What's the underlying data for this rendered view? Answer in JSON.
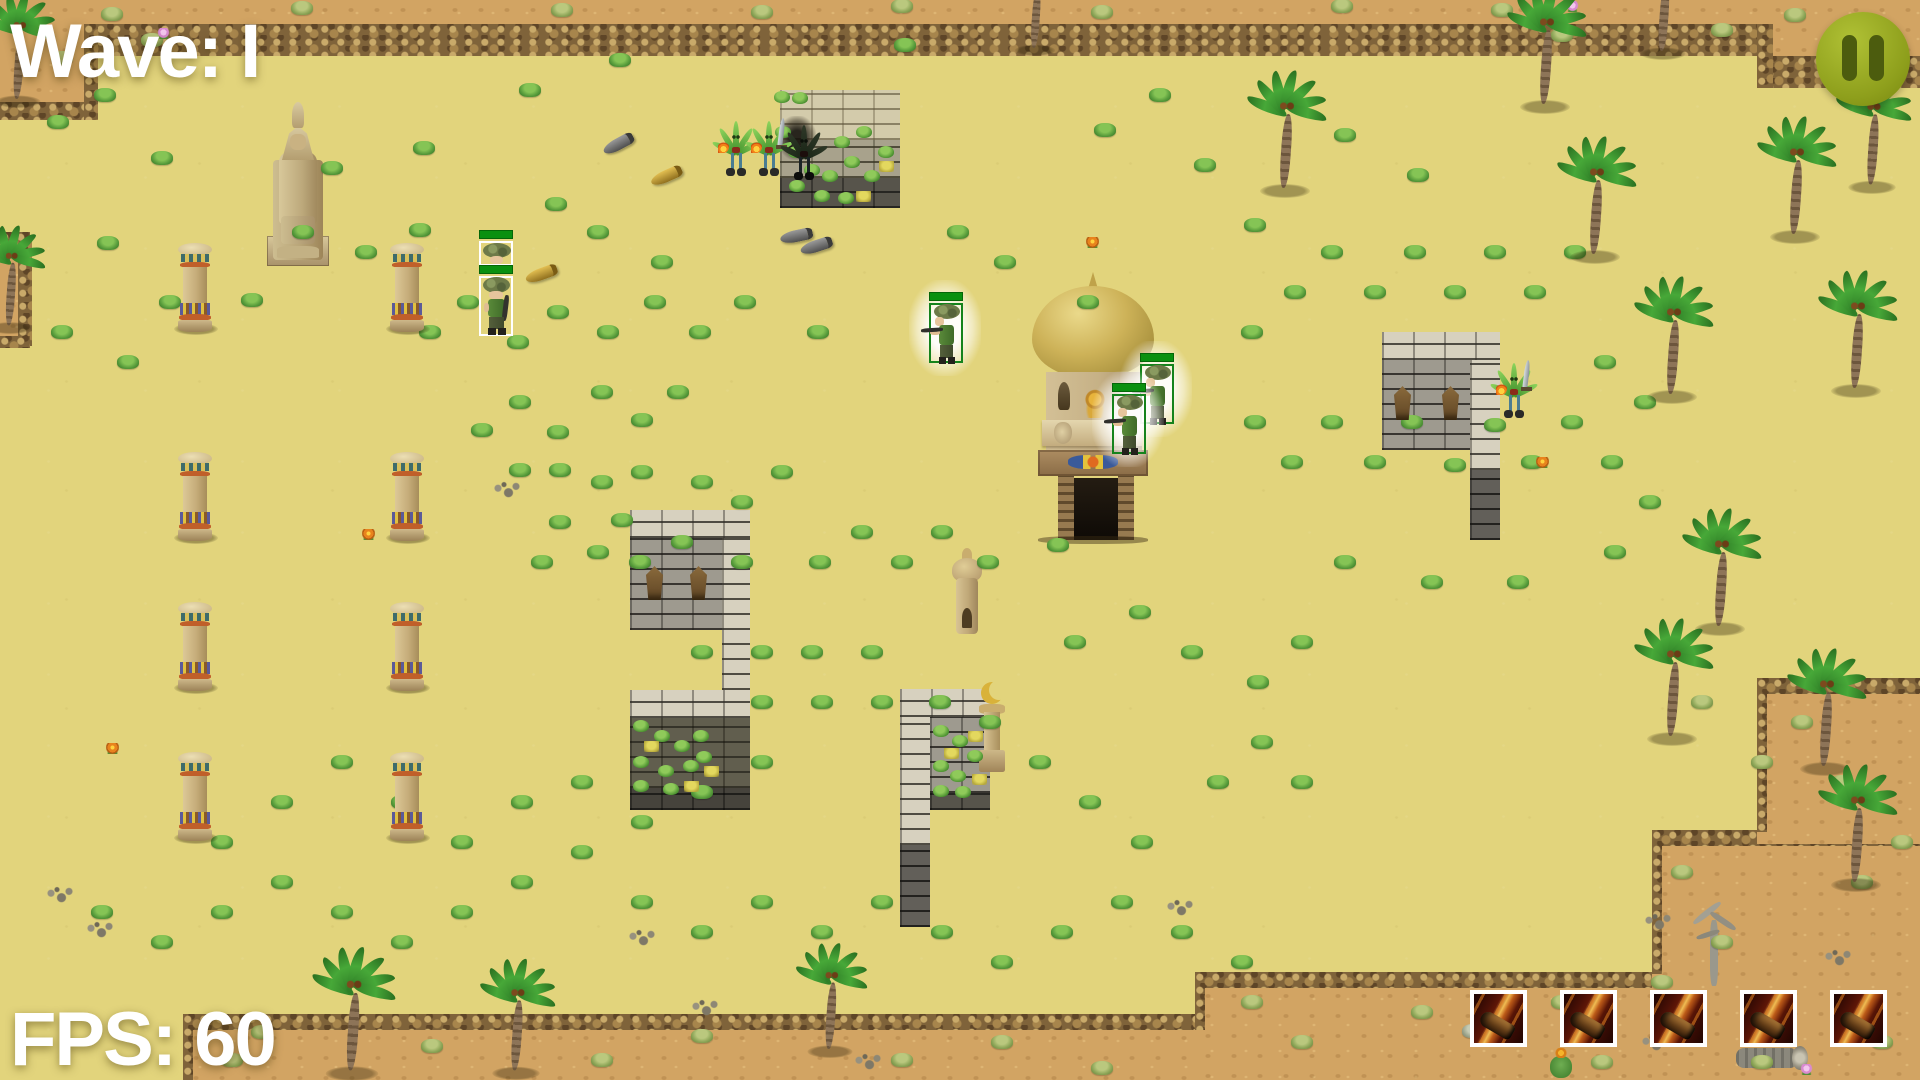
{
  "hud": {
    "wave_label": "Wave: I",
    "fps_label": "FPS: 60",
    "text_color": "#ffffff"
  },
  "pause_button": {
    "icon": "pause-icon",
    "bg_color": "#8e9f1c",
    "bar_color": "#4c5c0e"
  },
  "ability_bar": {
    "slot_count": 5,
    "icon": "fire-shot-icon",
    "border_color": "#ffffff"
  },
  "units": {
    "hp_color": "#0a9010",
    "soldiers": [
      {
        "x": 479,
        "y": 230,
        "style": "white",
        "variant": "hat",
        "glow": false,
        "hp": 1.0
      },
      {
        "x": 479,
        "y": 265,
        "style": "white",
        "variant": "down",
        "glow": false,
        "hp": 1.0
      },
      {
        "x": 929,
        "y": 292,
        "style": "green",
        "variant": "left",
        "glow": true,
        "hp": 1.0
      },
      {
        "x": 1140,
        "y": 353,
        "style": "green",
        "variant": "left",
        "glow": true,
        "hp": 1.0
      },
      {
        "x": 1112,
        "y": 383,
        "style": "green",
        "variant": "left",
        "glow": true,
        "hp": 1.0
      }
    ],
    "monsters": [
      {
        "x": 720,
        "y": 118,
        "sword": false,
        "flame": true,
        "dark": false
      },
      {
        "x": 753,
        "y": 118,
        "sword": true,
        "flame": true,
        "dark": false
      },
      {
        "x": 788,
        "y": 122,
        "sword": false,
        "flame": false,
        "dark": true
      },
      {
        "x": 1498,
        "y": 360,
        "sword": true,
        "flame": true,
        "dark": false
      }
    ]
  },
  "projectiles": [
    {
      "x": 602,
      "y": 138,
      "angle": -28,
      "color": "grey"
    },
    {
      "x": 650,
      "y": 170,
      "angle": -24,
      "color": "gold"
    },
    {
      "x": 525,
      "y": 268,
      "angle": -20,
      "color": "gold"
    },
    {
      "x": 780,
      "y": 230,
      "angle": -12,
      "color": "grey"
    },
    {
      "x": 800,
      "y": 240,
      "angle": -18,
      "color": "grey"
    }
  ],
  "map": {
    "columns": [
      [
        178,
        243
      ],
      [
        390,
        243
      ],
      [
        178,
        452
      ],
      [
        390,
        452
      ],
      [
        178,
        602
      ],
      [
        390,
        602
      ],
      [
        178,
        752
      ],
      [
        390,
        752
      ]
    ],
    "idols": [
      [
        646,
        566
      ],
      [
        690,
        566
      ],
      [
        1394,
        386
      ],
      [
        1442,
        386
      ]
    ],
    "palms": [
      [
        18,
        102,
        0.9
      ],
      [
        10,
        328,
        0.85
      ],
      [
        1035,
        50,
        0.8
      ],
      [
        1545,
        108,
        1.0
      ],
      [
        1663,
        54,
        0.9
      ],
      [
        1872,
        188,
        0.95
      ],
      [
        1285,
        192,
        1.0
      ],
      [
        1595,
        258,
        1.0
      ],
      [
        1672,
        398,
        1.0
      ],
      [
        1795,
        238,
        1.0
      ],
      [
        1856,
        392,
        1.0
      ],
      [
        1720,
        630,
        1.0
      ],
      [
        1672,
        740,
        1.0
      ],
      [
        1825,
        770,
        1.0
      ],
      [
        1856,
        886,
        1.0
      ],
      [
        352,
        1075,
        1.05
      ],
      [
        516,
        1074,
        0.95
      ],
      [
        830,
        1052,
        0.9
      ]
    ],
    "grass": [
      [
        105,
        95
      ],
      [
        58,
        122
      ],
      [
        162,
        158
      ],
      [
        332,
        168
      ],
      [
        424,
        148
      ],
      [
        303,
        232
      ],
      [
        366,
        252
      ],
      [
        420,
        230
      ],
      [
        108,
        243
      ],
      [
        252,
        300
      ],
      [
        170,
        302
      ],
      [
        62,
        332
      ],
      [
        128,
        362
      ],
      [
        430,
        332
      ],
      [
        468,
        302
      ],
      [
        518,
        342
      ],
      [
        558,
        312
      ],
      [
        608,
        332
      ],
      [
        655,
        302
      ],
      [
        700,
        332
      ],
      [
        745,
        302
      ],
      [
        818,
        332
      ],
      [
        598,
        232
      ],
      [
        556,
        204
      ],
      [
        662,
        262
      ],
      [
        958,
        232
      ],
      [
        1005,
        262
      ],
      [
        1088,
        302
      ],
      [
        530,
        90
      ],
      [
        620,
        60
      ],
      [
        905,
        45
      ],
      [
        1255,
        225
      ],
      [
        678,
        392
      ],
      [
        642,
        420
      ],
      [
        602,
        392
      ],
      [
        558,
        432
      ],
      [
        520,
        402
      ],
      [
        482,
        430
      ],
      [
        560,
        470
      ],
      [
        602,
        482
      ],
      [
        622,
        520
      ],
      [
        560,
        522
      ],
      [
        520,
        470
      ],
      [
        598,
        552
      ],
      [
        640,
        562
      ],
      [
        682,
        542
      ],
      [
        702,
        482
      ],
      [
        742,
        502
      ],
      [
        782,
        472
      ],
      [
        642,
        472
      ],
      [
        542,
        562
      ],
      [
        742,
        562
      ],
      [
        820,
        562
      ],
      [
        862,
        532
      ],
      [
        902,
        562
      ],
      [
        942,
        532
      ],
      [
        988,
        562
      ],
      [
        1058,
        545
      ],
      [
        1075,
        642
      ],
      [
        1140,
        612
      ],
      [
        1192,
        652
      ],
      [
        1258,
        682
      ],
      [
        1302,
        642
      ],
      [
        872,
        652
      ],
      [
        812,
        652
      ],
      [
        762,
        652
      ],
      [
        702,
        652
      ],
      [
        762,
        702
      ],
      [
        822,
        702
      ],
      [
        882,
        702
      ],
      [
        940,
        702
      ],
      [
        990,
        722
      ],
      [
        1040,
        762
      ],
      [
        1090,
        802
      ],
      [
        1142,
        842
      ],
      [
        762,
        762
      ],
      [
        702,
        792
      ],
      [
        642,
        822
      ],
      [
        582,
        852
      ],
      [
        522,
        882
      ],
      [
        462,
        912
      ],
      [
        402,
        942
      ],
      [
        342,
        912
      ],
      [
        282,
        882
      ],
      [
        222,
        912
      ],
      [
        162,
        942
      ],
      [
        102,
        912
      ],
      [
        222,
        842
      ],
      [
        282,
        802
      ],
      [
        342,
        762
      ],
      [
        402,
        802
      ],
      [
        462,
        842
      ],
      [
        522,
        802
      ],
      [
        582,
        782
      ],
      [
        642,
        902
      ],
      [
        702,
        932
      ],
      [
        762,
        902
      ],
      [
        822,
        932
      ],
      [
        882,
        902
      ],
      [
        942,
        932
      ],
      [
        1002,
        962
      ],
      [
        1062,
        932
      ],
      [
        1122,
        902
      ],
      [
        1182,
        932
      ],
      [
        1242,
        962
      ],
      [
        1255,
        422
      ],
      [
        1292,
        462
      ],
      [
        1332,
        422
      ],
      [
        1375,
        462
      ],
      [
        1412,
        422
      ],
      [
        1455,
        465
      ],
      [
        1495,
        425
      ],
      [
        1532,
        462
      ],
      [
        1572,
        422
      ],
      [
        1612,
        462
      ],
      [
        1650,
        502
      ],
      [
        1252,
        332
      ],
      [
        1295,
        292
      ],
      [
        1332,
        252
      ],
      [
        1375,
        292
      ],
      [
        1415,
        252
      ],
      [
        1455,
        292
      ],
      [
        1495,
        252
      ],
      [
        1535,
        292
      ],
      [
        1575,
        252
      ],
      [
        1615,
        552
      ],
      [
        1262,
        742
      ],
      [
        1218,
        782
      ],
      [
        1302,
        782
      ],
      [
        1345,
        562
      ],
      [
        1432,
        582
      ],
      [
        1518,
        582
      ],
      [
        1605,
        362
      ],
      [
        1645,
        402
      ],
      [
        1205,
        165
      ],
      [
        1105,
        130
      ],
      [
        1160,
        95
      ],
      [
        1345,
        135
      ],
      [
        1418,
        175
      ]
    ],
    "dry_grass": [
      [
        112,
        14
      ],
      [
        302,
        8
      ],
      [
        562,
        10
      ],
      [
        762,
        12
      ],
      [
        902,
        6
      ],
      [
        1102,
        12
      ],
      [
        1342,
        6
      ],
      [
        1502,
        10
      ],
      [
        1562,
        35
      ],
      [
        1722,
        30
      ],
      [
        1882,
        55
      ],
      [
        62,
        58
      ],
      [
        152,
        40
      ],
      [
        1795,
        15
      ],
      [
        432,
        1046
      ],
      [
        602,
        1060
      ],
      [
        702,
        1036
      ],
      [
        902,
        1060
      ],
      [
        1002,
        1042
      ],
      [
        1102,
        1068
      ],
      [
        1252,
        1002
      ],
      [
        1302,
        1042
      ],
      [
        1422,
        1012
      ],
      [
        1502,
        1032
      ],
      [
        1562,
        1002
      ],
      [
        1682,
        872
      ],
      [
        1722,
        942
      ],
      [
        1782,
        1002
      ],
      [
        1862,
        882
      ],
      [
        1882,
        1042
      ],
      [
        1702,
        702
      ],
      [
        1802,
        722
      ],
      [
        1762,
        762
      ],
      [
        1842,
        782
      ],
      [
        1902,
        842
      ],
      [
        1662,
        982
      ],
      [
        1602,
        1062
      ],
      [
        1762,
        1062
      ],
      [
        232,
        1060
      ],
      [
        262,
        1032
      ]
    ],
    "pebbles": [
      [
        507,
        490
      ],
      [
        1658,
        922
      ],
      [
        1838,
        958
      ],
      [
        642,
        938
      ],
      [
        705,
        1008
      ],
      [
        868,
        1062
      ],
      [
        60,
        895
      ],
      [
        100,
        930
      ],
      [
        1180,
        908
      ]
    ],
    "flowers": [
      {
        "x": 368,
        "y": 534,
        "c": "orange"
      },
      {
        "x": 1092,
        "y": 242,
        "c": "orange"
      },
      {
        "x": 112,
        "y": 748,
        "c": "orange"
      },
      {
        "x": 1542,
        "y": 462,
        "c": "orange"
      },
      {
        "x": 163,
        "y": 33,
        "c": "pink"
      },
      {
        "x": 1572,
        "y": 6,
        "c": "pink"
      }
    ],
    "wall_leaves": [
      [
        783,
        132
      ],
      [
        796,
        152
      ],
      [
        812,
        170
      ],
      [
        830,
        176
      ],
      [
        852,
        162
      ],
      [
        872,
        176
      ],
      [
        886,
        152
      ],
      [
        842,
        142
      ],
      [
        864,
        132
      ],
      [
        822,
        196
      ],
      [
        846,
        198
      ],
      [
        797,
        186
      ],
      [
        782,
        97
      ],
      [
        800,
        98
      ],
      [
        641,
        726
      ],
      [
        662,
        736
      ],
      [
        682,
        746
      ],
      [
        701,
        736
      ],
      [
        641,
        762
      ],
      [
        666,
        771
      ],
      [
        691,
        766
      ],
      [
        641,
        786
      ],
      [
        671,
        789
      ],
      [
        704,
        757
      ],
      [
        941,
        731
      ],
      [
        960,
        741
      ],
      [
        975,
        756
      ],
      [
        941,
        766
      ],
      [
        958,
        776
      ],
      [
        941,
        791
      ],
      [
        963,
        792
      ]
    ],
    "wall_ytufts": [
      [
        886,
        166
      ],
      [
        863,
        196
      ],
      [
        651,
        746
      ],
      [
        691,
        786
      ],
      [
        711,
        771
      ],
      [
        975,
        736
      ],
      [
        951,
        753
      ],
      [
        979,
        779
      ]
    ]
  }
}
